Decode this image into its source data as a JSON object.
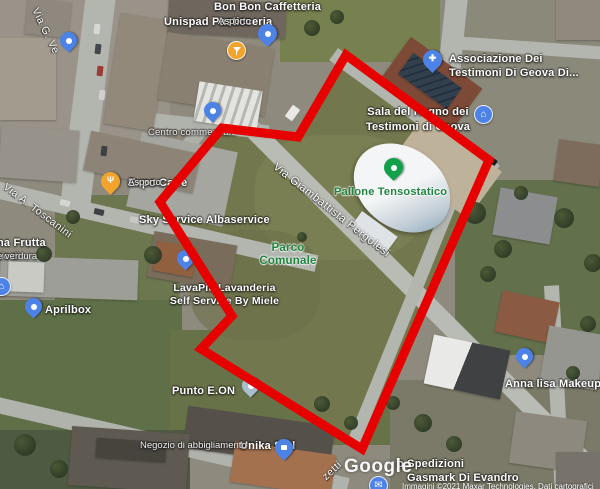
{
  "attribution": {
    "watermark": "Google",
    "copyright": "Immagini ©2021 Maxar Technologies, Dati cartografici"
  },
  "streets": {
    "via_g_ve": "Via G. Ve",
    "toscanini": "Via A. Toscanini",
    "pergolesi": "Via Giambattista Pergolesi",
    "zetti": "zetti"
  },
  "pois": {
    "bon_bon": {
      "name": "Bon Bon Caffetteria",
      "icon": "cocktail-badge"
    },
    "unispad": {
      "name": "Unispad Pasticceria",
      "sub": "Asporto",
      "icon": "blue-pin"
    },
    "associazione": {
      "line1": "Associazione Dei",
      "line2": "Testimoni Di Geova Di...",
      "icon": "church-pin"
    },
    "sala_regno": {
      "line1": "Sala del Regno dei",
      "line2": "Testimoni di Geova",
      "icon": "building-badge"
    },
    "pallone": {
      "name": "Pallone Tensostatico",
      "icon": "green-pin"
    },
    "centro": {
      "name": "Centro commerciale",
      "icon": "blue-pin"
    },
    "expo": {
      "name": "Expo Caffè",
      "sub": "Asporto",
      "icon": "restaurant-pin"
    },
    "sky_service": {
      "name": "Sky Service Albaservice"
    },
    "anna_frutta": {
      "line1": "na Frutta",
      "line2": "zio di",
      "line3": "e verdura",
      "icon": "blue-badge"
    },
    "aprilbox": {
      "name": "Aprilbox",
      "icon": "blue-pin"
    },
    "lavapiu": {
      "line1": "LavaPiù Lavanderia",
      "line2": "Self Service By Miele",
      "icon": "blue-pin"
    },
    "parco": {
      "line1": "Parco",
      "line2": "Comunale"
    },
    "punto_eon": {
      "name": "Punto E.ON",
      "icon": "pale-pin"
    },
    "unika": {
      "name": "Unika S.r.l",
      "sub": "Negozio di abbigliamento",
      "icon": "shop-pin"
    },
    "spedizioni": {
      "name": "o Spedizioni",
      "icon": "mail-badge"
    },
    "gasmark": {
      "name": "Gasmark Di Evandro"
    },
    "anna_lisa": {
      "name": "Anna lisa Makeup",
      "icon": "blue-pin"
    }
  },
  "colors": {
    "overlay_red": "#e60000",
    "park_label_green": "#1f8540",
    "pin_blue": "#4d82e6",
    "pin_green": "#12a04b",
    "pin_amber": "#f0a42c",
    "pin_pale": "#a9bfd0"
  }
}
